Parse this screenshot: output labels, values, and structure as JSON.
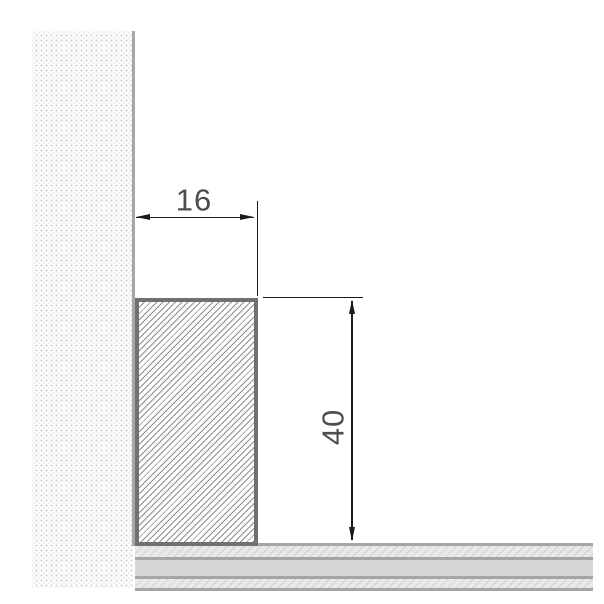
{
  "drawing": {
    "type": "technical-section-drawing",
    "dimensions": {
      "width_label": "16",
      "height_label": "40"
    },
    "colors": {
      "dimension_line": "#1a1a1a",
      "dimension_text": "#4d4d4d",
      "profile_border": "#717171",
      "profile_hatch": "#8d8d8d",
      "wall_face_line": "#a8a8a8",
      "wall_dot": "#d0d0d0",
      "wall_dot_faint": "#ebebeb",
      "floor_edge_line": "#a6a6a6",
      "floor_solid_fill": "#d6d6d6",
      "floor_hatch_fill": "#e8e8e8"
    }
  }
}
